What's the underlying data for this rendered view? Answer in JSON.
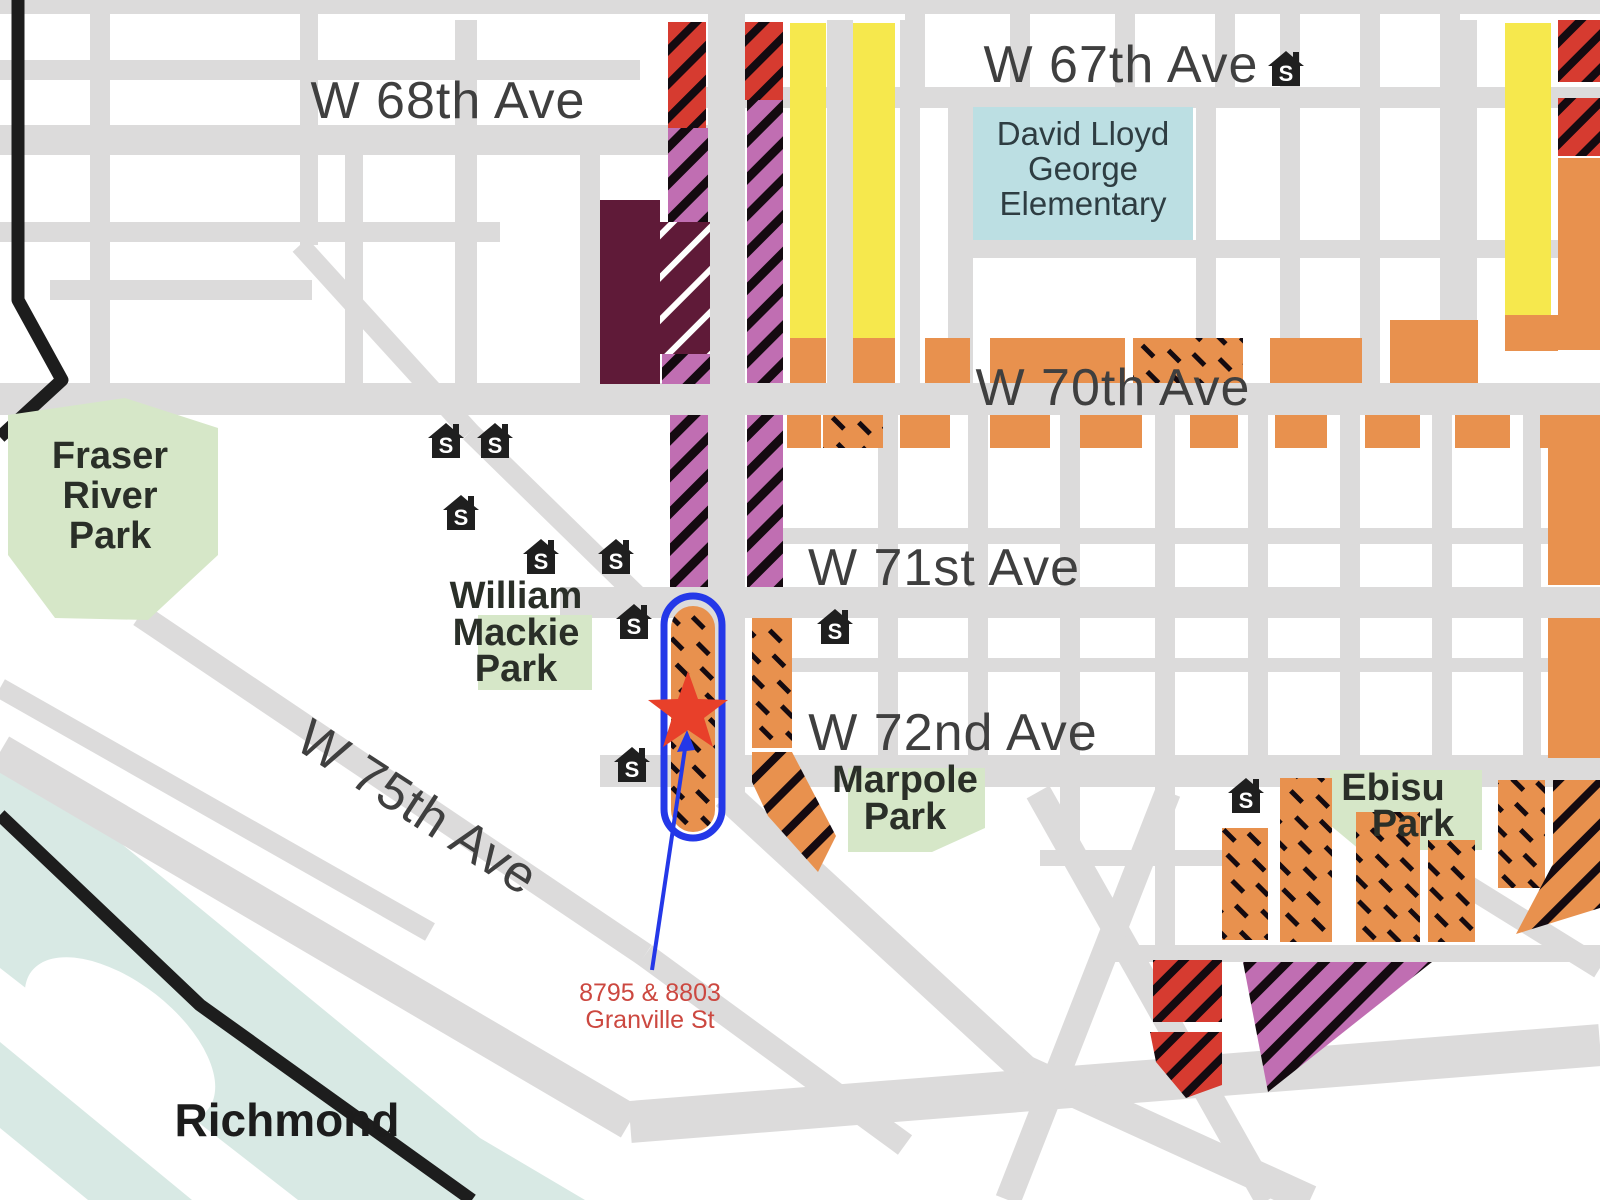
{
  "colors": {
    "road_gray": "#dcdbdb",
    "park_green": "#d6e7c8",
    "school_blue": "#bcdfe3",
    "water_teal": "#d8e9e4",
    "zone_orange": "#e8914e",
    "zone_yellow": "#f6e84d",
    "zone_red": "#d63b30",
    "zone_purple": "#c06eb2",
    "zone_maroon": "#5f1a38",
    "hatch_black": "#140a10",
    "hatch_white": "#ffffff",
    "boundary_black": "#1d1d1d",
    "highlight_blue": "#2438e8",
    "star_red": "#e8402a",
    "label_red": "#cc4840",
    "street_text": "#3f3f3f",
    "park_text": "#2a2f28",
    "school_text": "#2e3d42",
    "city_text": "#1c1c1c"
  },
  "labels": {
    "streets": {
      "w67": "W 67th Ave",
      "w68": "W 68th Ave",
      "w70": "W 70th Ave",
      "w71": "W 71st Ave",
      "w72": "W 72nd Ave",
      "w75": "W 75th Ave"
    },
    "city": {
      "richmond": "Richmond"
    },
    "parks": {
      "fraser_l1": "Fraser",
      "fraser_l2": "River",
      "fraser_l3": "Park",
      "mackie_l1": "William",
      "mackie_l2": "Mackie",
      "mackie_l3": "Park",
      "marpole_l1": "Marpole",
      "marpole_l2": "Park",
      "ebisu_l1": "Ebisu",
      "ebisu_l2": "Park"
    },
    "school_site": {
      "l1": "David Lloyd",
      "l2": "George",
      "l3": "Elementary"
    },
    "annotation": {
      "l1": "8795 & 8803",
      "l2": "Granville St"
    },
    "school_icon_letter": "S"
  }
}
